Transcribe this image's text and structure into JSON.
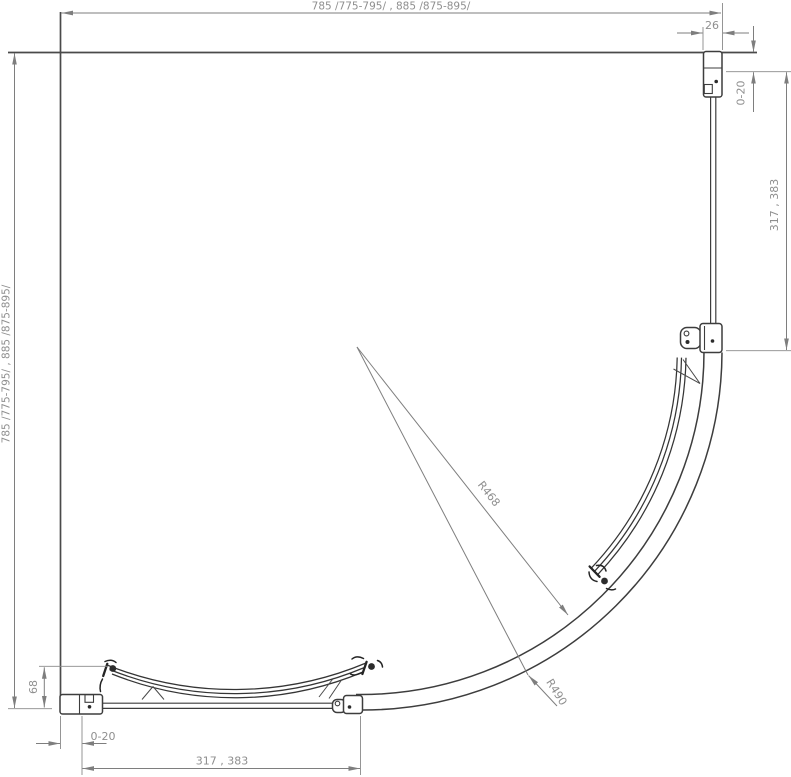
{
  "meta": {
    "background": "#ffffff",
    "line_color": "#3d3d3d",
    "dim_line_color": "#7e7e7e",
    "dim_text_color": "#8f8f8f"
  },
  "dimensions": {
    "top_width": "785 /775-795/ , 885 /875-895/",
    "left_height": "785 /775-795/ , 885 /875-895/",
    "profile_width": "26",
    "right_adjustment": "0-20",
    "right_fixed_panel": "317 , 383",
    "wall_clearance": "68",
    "bottom_adjustment": "0-20",
    "bottom_fixed_panel": "317 , 383",
    "radius_inner": "R468",
    "radius_outer": "R490"
  }
}
